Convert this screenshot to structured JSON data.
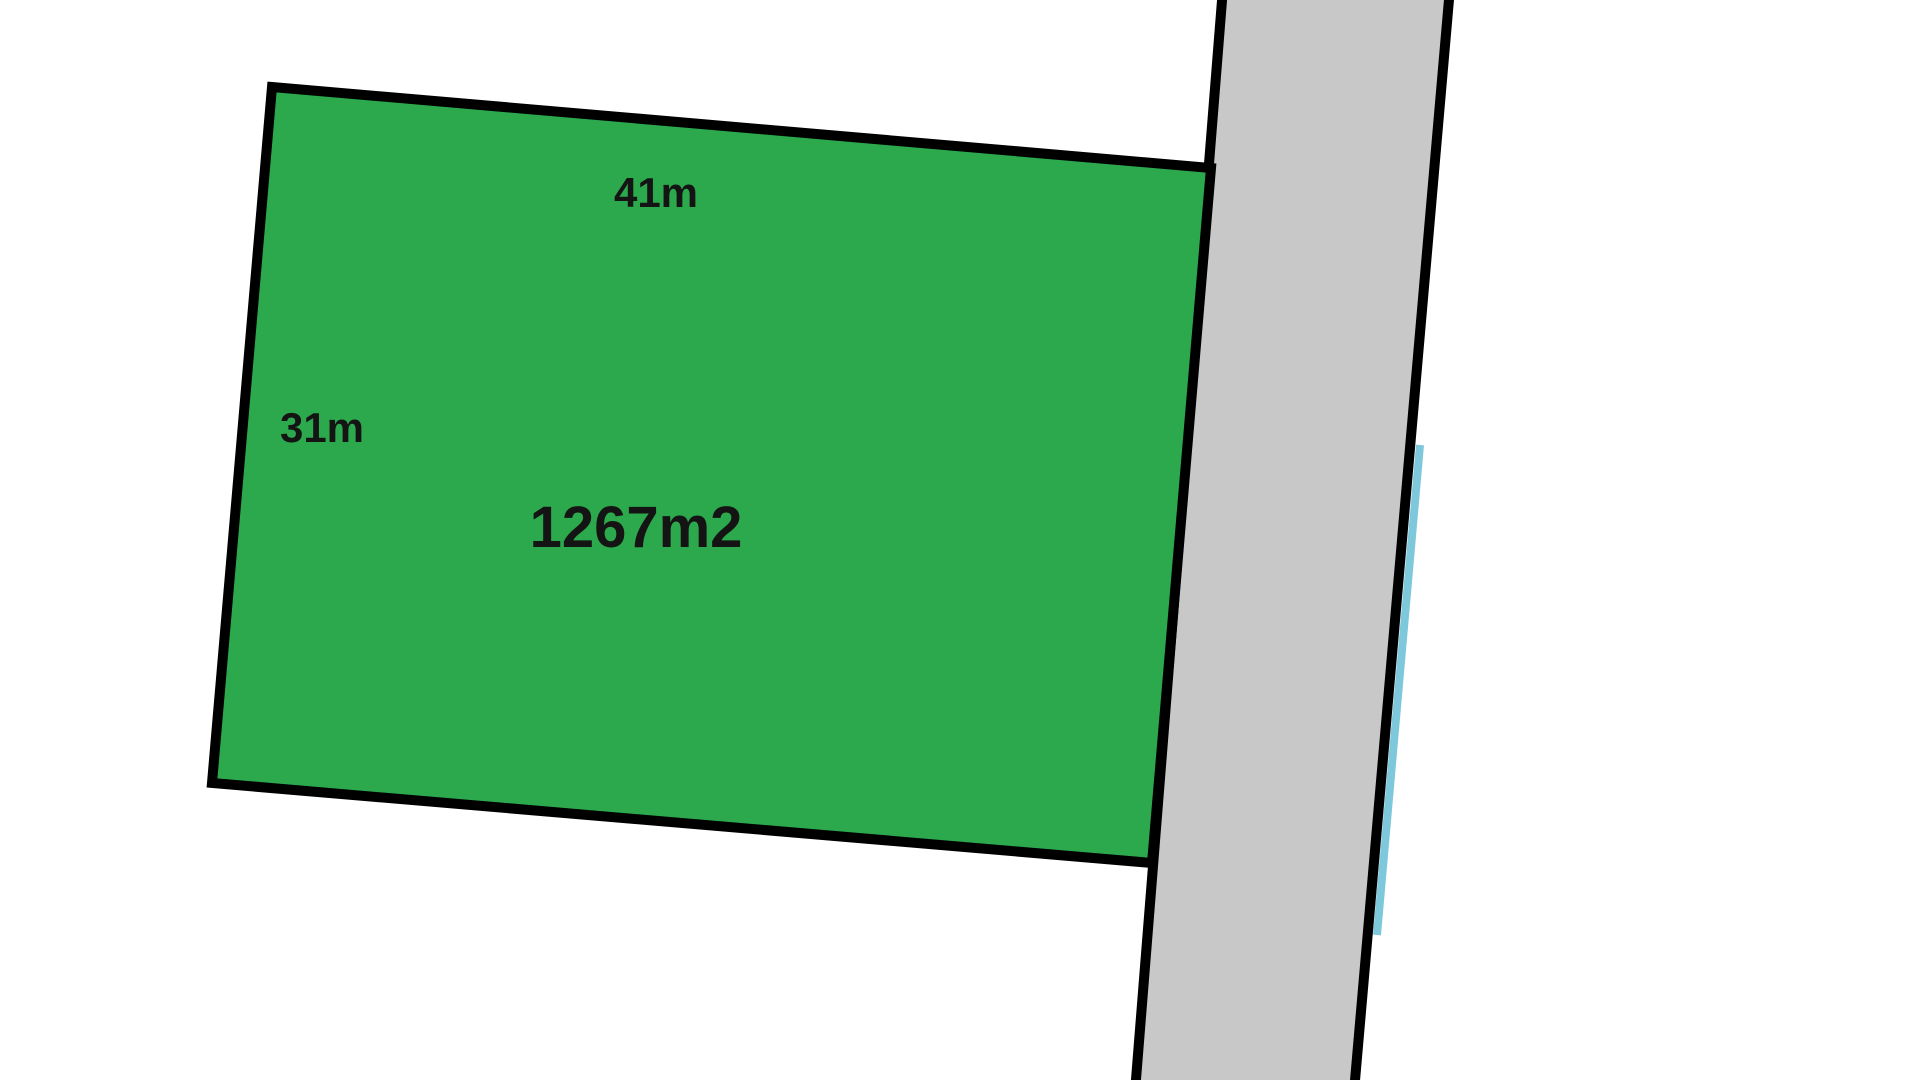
{
  "background_color": "#ffffff",
  "parcel": {
    "top_side_label": "41m",
    "left_side_label": "31m",
    "area_label": "1267m2",
    "fill_color": "#2ca94c",
    "border_color": "#000000",
    "label_color": "#141414"
  },
  "road": {
    "fill_color": "#c8c8c8",
    "border_color": "#000000"
  },
  "boundary_line": {
    "color": "#7ec8dc"
  }
}
